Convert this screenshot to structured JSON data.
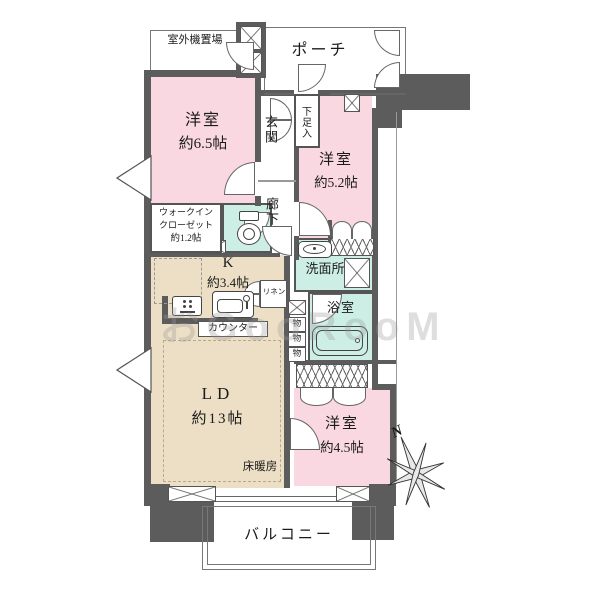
{
  "plan": {
    "rooms": {
      "outdoor_unit": {
        "name": "室外機置場"
      },
      "porch": {
        "name": "ポーチ"
      },
      "bedroom1": {
        "name": "洋室",
        "size": "約6.5帖"
      },
      "entrance": {
        "name": "玄関"
      },
      "shoe_box": {
        "name": "下足入"
      },
      "hallway": {
        "name": "廊下"
      },
      "bedroom2": {
        "name": "洋室",
        "size": "約5.2帖"
      },
      "walk_in_closet": {
        "line1": "ウォークイン",
        "line2": "クローゼット",
        "line3": "約1.2帖"
      },
      "kitchen": {
        "name": "K",
        "size": "約3.4帖"
      },
      "counter": {
        "name": "カウンター"
      },
      "washroom": {
        "name": "洗面所"
      },
      "linen": {
        "name": "リネン"
      },
      "bathroom": {
        "name": "浴室"
      },
      "storage": {
        "name": "物"
      },
      "living_dining": {
        "name": "LD",
        "size": "約13帖"
      },
      "floor_heating": {
        "name": "床暖房"
      },
      "bedroom3": {
        "name": "洋室",
        "size": "約4.5帖"
      },
      "balcony": {
        "name": "バルコニー"
      }
    },
    "compass": {
      "label": "N"
    },
    "watermark": "おGooRooM",
    "colors": {
      "wall": "#5c5c5c",
      "bedroom_pink": "#f9d8e1",
      "kitchen_beige": "#ecdfc5",
      "wet_area_cyan": "#cdeee5"
    }
  }
}
